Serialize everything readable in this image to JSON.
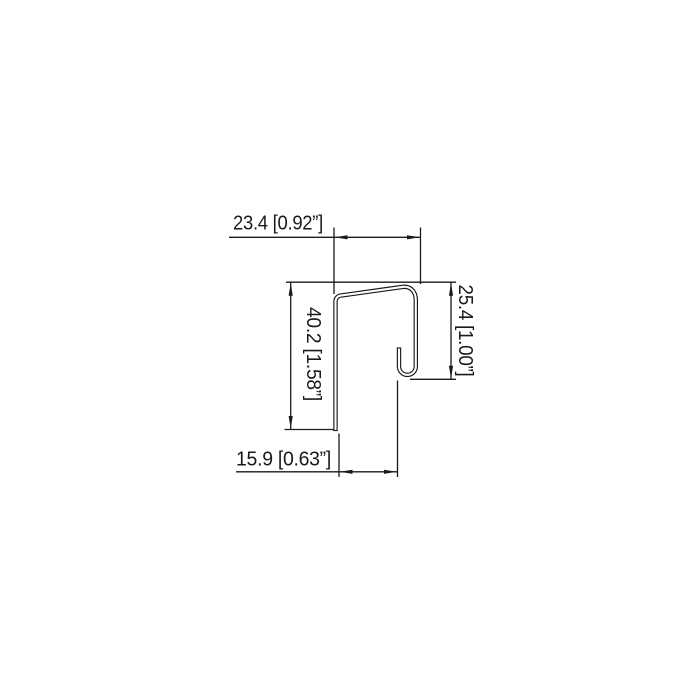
{
  "canvas": {
    "background": "#ffffff",
    "line_color": "#1a1a1a"
  },
  "dimensions": {
    "top_width": {
      "label": "23.4 [0.92”]",
      "mm": "23.4",
      "inches": "0.92”"
    },
    "right_height": {
      "label": "25.4 [1.00”]",
      "mm": "25.4",
      "inches": "1.00”"
    },
    "left_height": {
      "label": "40.2 [1.58”]",
      "mm": "40.2",
      "inches": "1.58”"
    },
    "bottom_width": {
      "label": "15.9 [0.63”]",
      "mm": "15.9",
      "inches": "0.63”"
    }
  }
}
